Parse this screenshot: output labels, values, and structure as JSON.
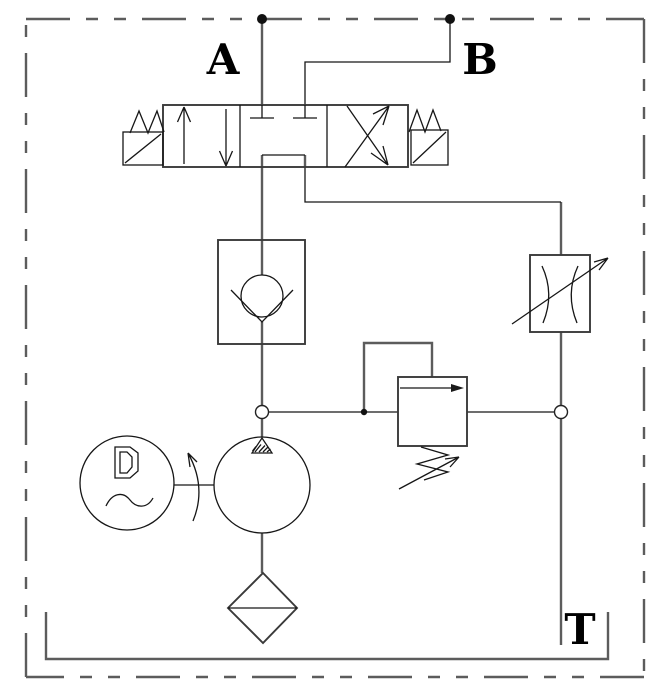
{
  "diagram": {
    "type": "hydraulic-circuit-schematic",
    "labels": {
      "port_a": "A",
      "port_b": "B",
      "tank": "T"
    },
    "colors": {
      "background": "#ffffff",
      "pipe_line": "#5c5c5c",
      "component_line": "#3a3a3a",
      "detail_line": "#161616",
      "label_text": "#000000"
    },
    "components": [
      "port-a-connection",
      "port-b-connection",
      "solenoid-directional-valve-4-3",
      "left-solenoid-with-spring",
      "right-solenoid-with-spring",
      "check-valve",
      "variable-throttle-valve",
      "pressure-relief-valve",
      "electric-motor-ac",
      "hydraulic-pump",
      "suction-filter",
      "reservoir-tank",
      "enclosure-boundary"
    ]
  }
}
